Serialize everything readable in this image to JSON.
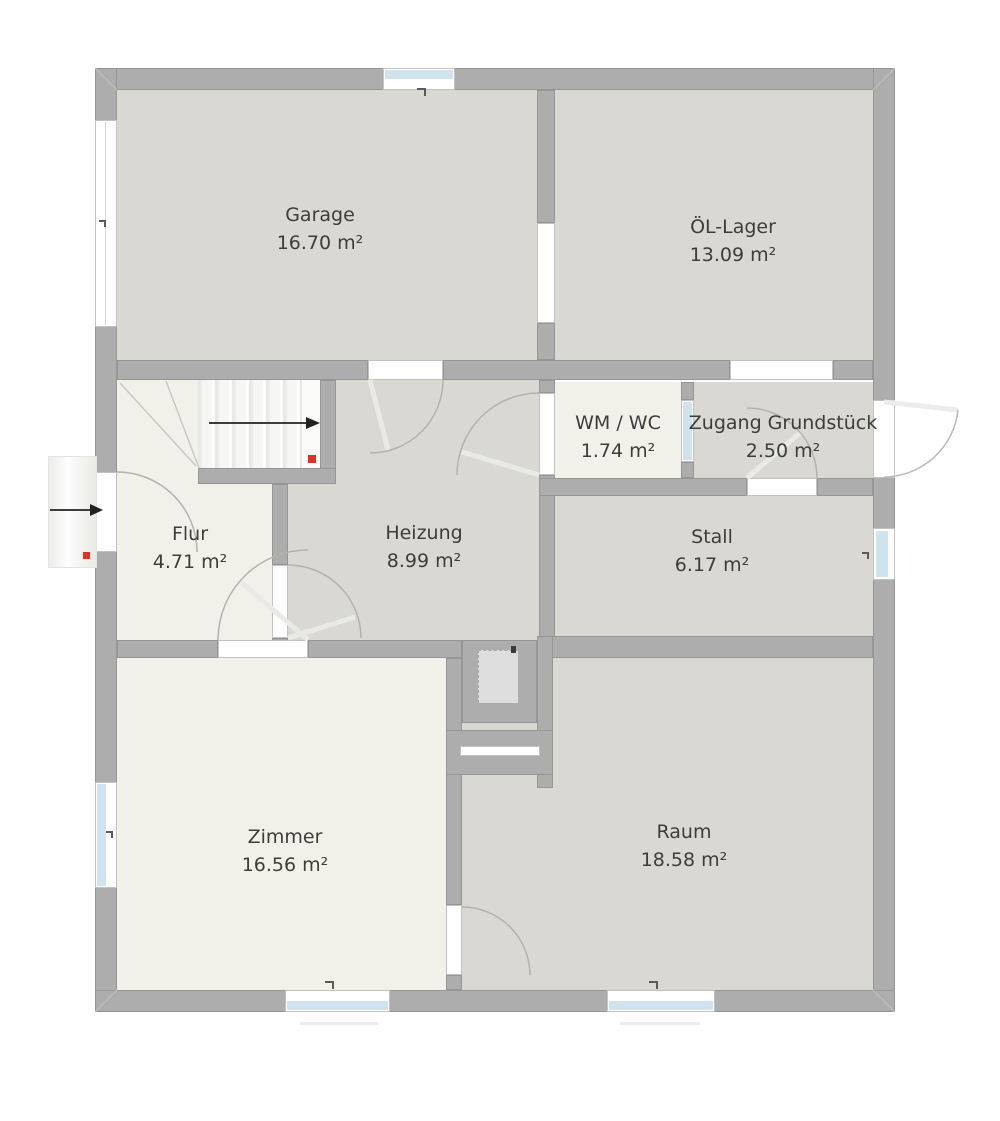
{
  "plan": {
    "rooms": [
      {
        "id": "garage",
        "name": "Garage",
        "area": "16.70 m²"
      },
      {
        "id": "oel-lager",
        "name": "ÖL-Lager",
        "area": "13.09 m²"
      },
      {
        "id": "wm-wc",
        "name": "WM / WC",
        "area": "1.74 m²"
      },
      {
        "id": "zugang",
        "name": "Zugang Grundstück",
        "area": "2.50 m²"
      },
      {
        "id": "flur",
        "name": "Flur",
        "area": "4.71 m²"
      },
      {
        "id": "heizung",
        "name": "Heizung",
        "area": "8.99 m²"
      },
      {
        "id": "stall",
        "name": "Stall",
        "area": "6.17 m²"
      },
      {
        "id": "zimmer",
        "name": "Zimmer",
        "area": "16.56 m²"
      },
      {
        "id": "raum",
        "name": "Raum",
        "area": "18.58 m²"
      }
    ],
    "icons": {
      "entry_arrow": "→",
      "stair_direction_arrow": "→"
    },
    "markers": {
      "entry_marker": "red-square",
      "stair_marker": "red-square"
    },
    "colors": {
      "wall": "#adadad",
      "wall_edge": "#969696",
      "floor_gray": "#d9d8d3",
      "floor_cream": "#f2f1e9",
      "window_blue": "#cfe2ee",
      "marker_red": "#e03222",
      "arc": "#b3b3ae",
      "panel": "#eaeae4",
      "label": "#3d3d3d"
    }
  }
}
